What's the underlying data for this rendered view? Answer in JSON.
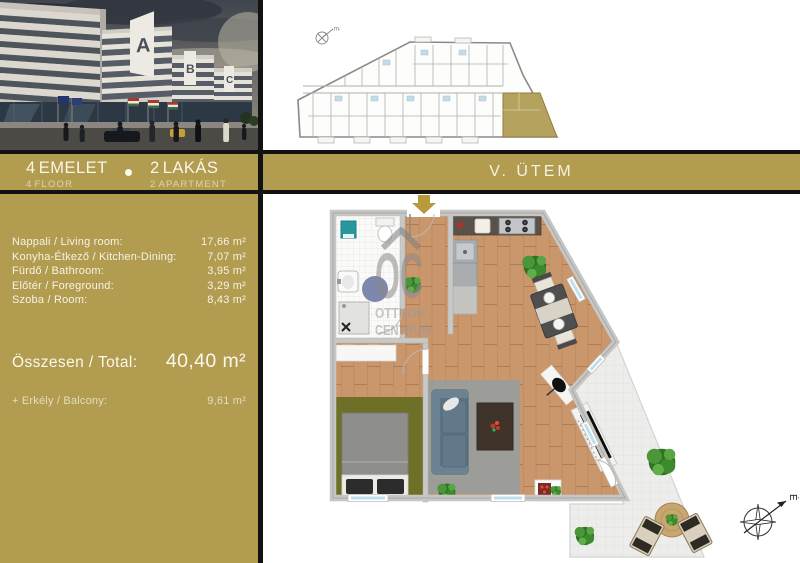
{
  "header": {
    "floor": {
      "value": "4",
      "hu": "EMELET",
      "en": "FLOOR"
    },
    "apartment": {
      "value": "2",
      "hu": "LAKÁS",
      "en": "APARTMENT"
    },
    "phase_label": "V. ÜTEM"
  },
  "rooms": {
    "items": [
      {
        "label": "Nappali / Living room:",
        "value": "17,66 m²"
      },
      {
        "label": "Konyha-Étkező / Kitchen-Dining:",
        "value": "7,07 m²"
      },
      {
        "label": "Fürdő / Bathroom:",
        "value": "3,95 m²"
      },
      {
        "label": "Előtér / Foreground:",
        "value": "3,29 m²"
      },
      {
        "label": "Szoba / Room:",
        "value": "8,43 m²"
      }
    ],
    "total": {
      "label": "Összesen / Total:",
      "value": "40,40 m²"
    },
    "balcony": {
      "label": "+  Erkély / Balcony:",
      "value": "9,61 m²"
    }
  },
  "watermark": {
    "logo": "OC",
    "line1": "OTTHON",
    "line2": "CENTRUM"
  },
  "compass": {
    "north_label": "É"
  },
  "building_labels": [
    "A",
    "B",
    "C"
  ],
  "colors": {
    "gold": "#b19c4f",
    "divider": "#121212",
    "highlight_unit": "#b5a25e",
    "wood_floor": "#ca966c",
    "arrow": "#b79a3c"
  }
}
